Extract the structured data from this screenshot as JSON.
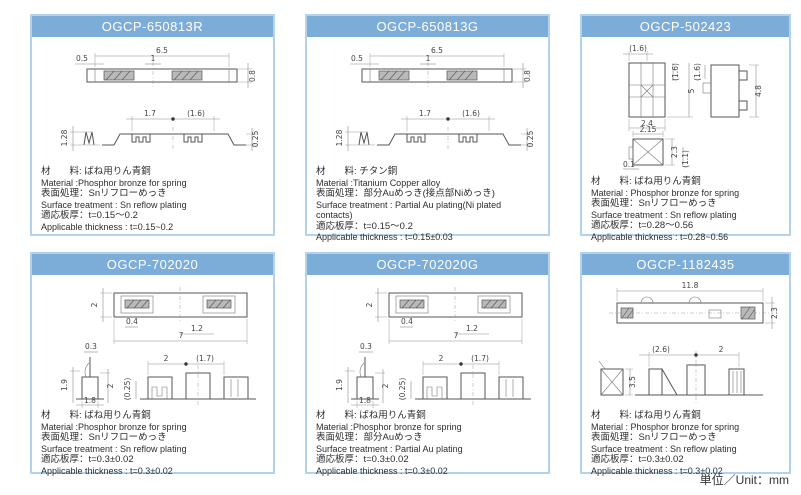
{
  "page": {
    "unit_label": "単位／Unit：mm",
    "colors": {
      "header_bg": "#7cadd9",
      "panel_border": "#b3d2ec",
      "header_text": "#ffffff"
    }
  },
  "panels": [
    {
      "title": "OGCP-650813R",
      "dims": [
        "6.5",
        "0.5",
        "1",
        "0.8",
        "1.7",
        "(1.6)",
        "1.28",
        "0.25"
      ],
      "specs": [
        "材　　料: ばね用りん青銅",
        "Material :Phosphor bronze for spring",
        "表面処理：Snリフローめっき",
        "Surface treatment : Sn reflow plating",
        "適応板厚：t=0.15～0.2",
        "Applicable thickness : t=0.15~0.2"
      ]
    },
    {
      "title": "OGCP-650813G",
      "dims": [
        "6.5",
        "0.5",
        "1",
        "0.8",
        "1.7",
        "(1.6)",
        "1.28",
        "0.25"
      ],
      "specs": [
        "材　　料: チタン銅",
        "Material :Titanium Copper alloy",
        "表面処理：部分Auめっき(接点部Niめっき)",
        "Surface treatment : Partial Au plating(Ni plated contacts)",
        "適応板厚：t=0.15～0.2",
        "Applicable thickness : t=0.15±0.03"
      ]
    },
    {
      "title": "OGCP-502423",
      "dims": [
        "(1.6)",
        "(1.6)",
        "(1.6)",
        "5",
        "2.4",
        "4.8",
        "2.15",
        "0.1",
        "2.3",
        "(1.1)"
      ],
      "specs": [
        "材　　料: ばね用りん青銅",
        "Material : Phosphor bronze for spring",
        "表面処理：Snリフローめっき",
        "Surface treatment : Sn reflow plating",
        "適応板厚：t=0.28～0.56",
        "Applicable thickness : t=0.28~0.56"
      ]
    },
    {
      "title": "OGCP-702020",
      "dims": [
        "2",
        "0.4",
        "1.2",
        "7",
        "0.3",
        "1.9",
        "2",
        "1.8",
        "(0.25)",
        "2",
        "(1.7)"
      ],
      "specs": [
        "材　　料: ばね用りん青銅",
        "Material :Phosphor bronze for spring",
        "表面処理：Snリフローめっき",
        "Surface treatment : Sn reflow plating",
        "適応板厚：t=0.3±0.02",
        "Applicable thickness : t=0.3±0.02"
      ]
    },
    {
      "title": "OGCP-702020G",
      "dims": [
        "2",
        "0.4",
        "1.2",
        "7",
        "0.3",
        "1.9",
        "2",
        "1.8",
        "(0.25)",
        "2",
        "(1.7)"
      ],
      "specs": [
        "材　　料: ばね用りん青銅",
        "Material :Phosphor bronze for spring",
        "表面処理：部分Auめっき",
        "Surface treatment : Partial Au plating",
        "適応板厚：t=0.3±0.02",
        "Applicable thickness : t=0.3±0.02"
      ]
    },
    {
      "title": "OGCP-1182435",
      "dims": [
        "11.8",
        "2.3",
        "(2.6)",
        "2",
        "3.5"
      ],
      "specs": [
        "材　　料: ばね用りん青銅",
        "Material : Phosphor bronze for spring",
        "表面処理：Snリフローめっき",
        "Surface treatment : Sn reflow plating",
        "適応板厚：t=0.3±0.02",
        "Applicable thickness : t=0.3±0.02"
      ]
    }
  ]
}
